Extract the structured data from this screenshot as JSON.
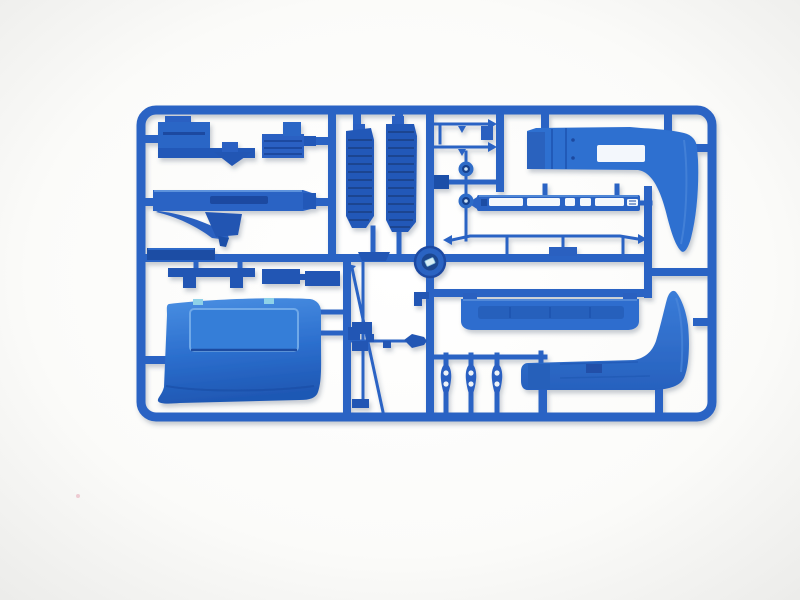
{
  "meta": {
    "alt": "Product photo of a blue injection-moulded plastic model-kit sprue (parts tree) with truck cab parts on a plain white background",
    "subject": "blue styrene model kit sprue"
  },
  "colors": {
    "background_center": "#ffffff",
    "background_edge": "#ebebe9",
    "plastic_mid": "#2b64c4",
    "plastic_dark": "#1d4da6",
    "plastic_deep": "#16408c",
    "plastic_bright": "#2e6fd0",
    "panel_top": "#4a8fe2",
    "panel_bottom": "#1f58b4",
    "highlight": "#5d92dc",
    "slot_white": "#f3f7fc",
    "hub_center": "#d8eef6",
    "cyan_notch": "#8fd2e8",
    "shadow": "#8e97a3",
    "dust_speck": "#e9bcc6"
  },
  "sprue": {
    "material": "blue styrene plastic",
    "frame_shape": "rounded rectangle",
    "parts": [
      {
        "id": "cab-step-assembly",
        "location": "top-left"
      },
      {
        "id": "dashboard",
        "location": "upper-left"
      },
      {
        "id": "sill-strip",
        "location": "mid-left"
      },
      {
        "id": "mounting-brackets",
        "location": "mid-left"
      },
      {
        "id": "roof-deflector-panel",
        "location": "bottom-left"
      },
      {
        "id": "entry-step-grille-left",
        "location": "top-center"
      },
      {
        "id": "entry-step-grille-right",
        "location": "top-center"
      },
      {
        "id": "washer-discs",
        "location": "center"
      },
      {
        "id": "chassis-side-strip",
        "location": "upper-right"
      },
      {
        "id": "side-fairing-upper",
        "location": "top-right"
      },
      {
        "id": "roof-light-bar",
        "location": "mid-right"
      },
      {
        "id": "sun-visor-bumper",
        "location": "center-right"
      },
      {
        "id": "side-fairing-lower",
        "location": "bottom-right"
      },
      {
        "id": "mirror-arm-brackets",
        "location": "bottom-center"
      },
      {
        "id": "wiper-antenna-rods",
        "location": "center-bottom"
      },
      {
        "id": "sprue-center-hub",
        "location": "center"
      }
    ]
  }
}
